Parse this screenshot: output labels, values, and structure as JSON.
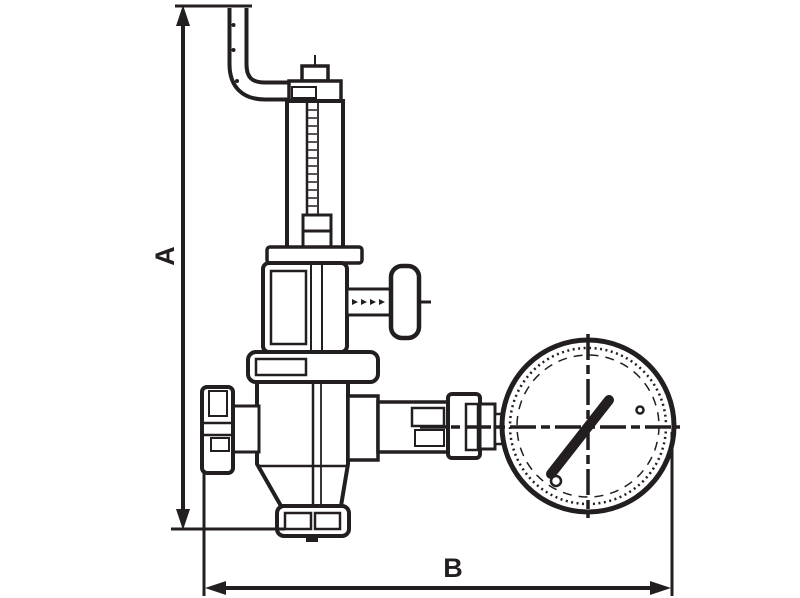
{
  "diagram": {
    "dimensions": {
      "vertical_label": "A",
      "horizontal_label": "B"
    },
    "colors": {
      "line": "#231f20",
      "background": "#ffffff"
    }
  }
}
